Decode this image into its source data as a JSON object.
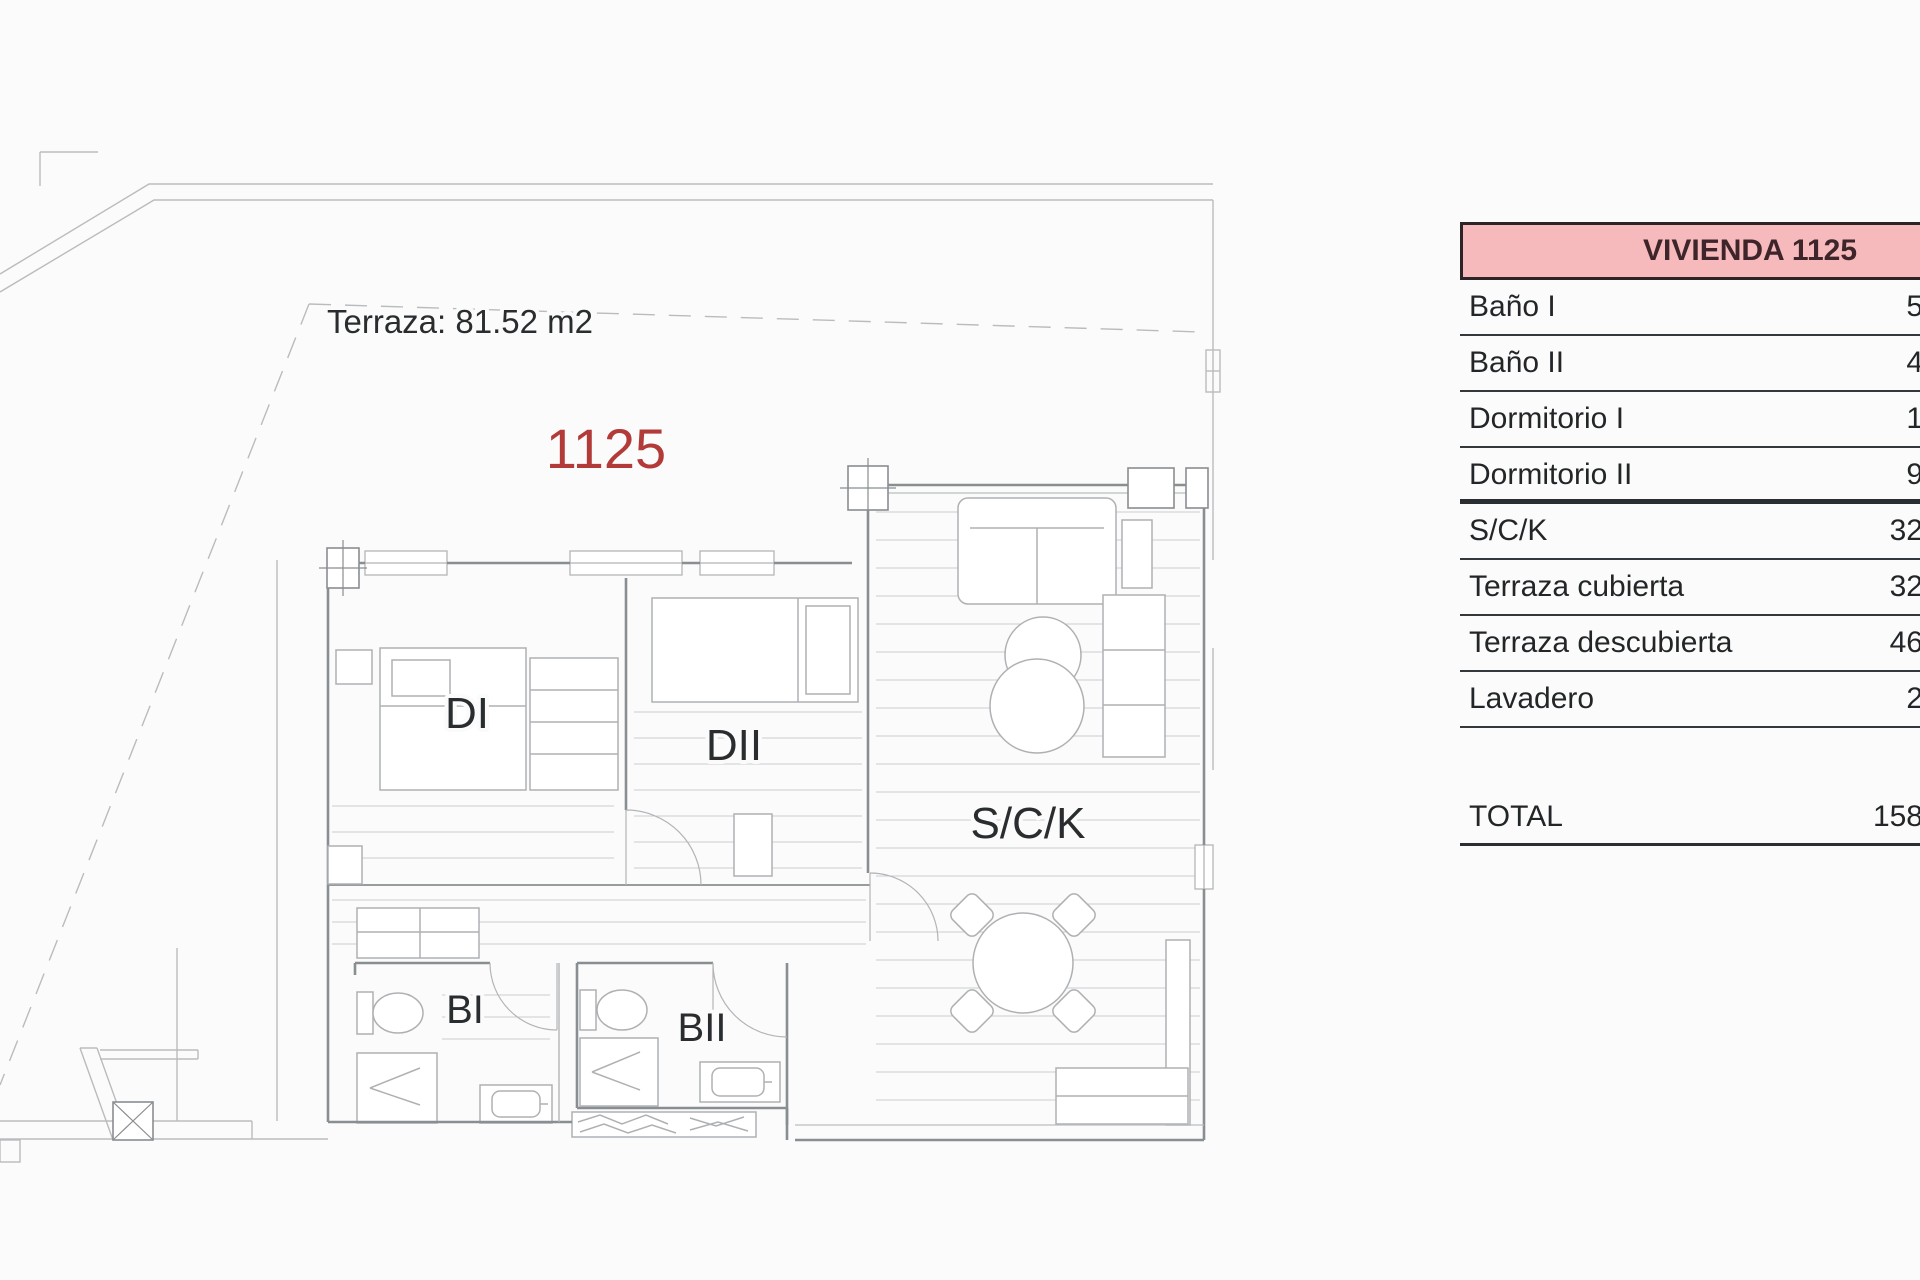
{
  "plan": {
    "terrace_area_label": "Terraza: 81.52 m2",
    "unit_number": "1125",
    "unit_number_color": "#b23b39",
    "room_labels": {
      "dormitorio1": "DI",
      "dormitorio2": "DII",
      "salon_cocina": "S/C/K",
      "bano1": "BI",
      "bano2": "BII"
    },
    "line_colors": {
      "thin": "#b9bcbe",
      "wall": "#898e92",
      "furniture": "#aeb1b4",
      "decking": "#cbcdcf"
    }
  },
  "table": {
    "header": "VIVIENDA 1125",
    "header_bg": "#f6b9bc",
    "header_border": "#2c2427",
    "rows": [
      {
        "label": "Baño I",
        "value": "5"
      },
      {
        "label": "Baño II",
        "value": "4"
      },
      {
        "label": "Dormitorio I",
        "value": "1"
      },
      {
        "label": "Dormitorio II",
        "value": "9"
      },
      {
        "label": "S/C/K",
        "value": "32"
      },
      {
        "label": "Terraza cubierta",
        "value": "32"
      },
      {
        "label": "Terraza descubierta",
        "value": "46"
      },
      {
        "label": "Lavadero",
        "value": "2"
      }
    ],
    "total": {
      "label": "TOTAL",
      "value": "158"
    }
  }
}
